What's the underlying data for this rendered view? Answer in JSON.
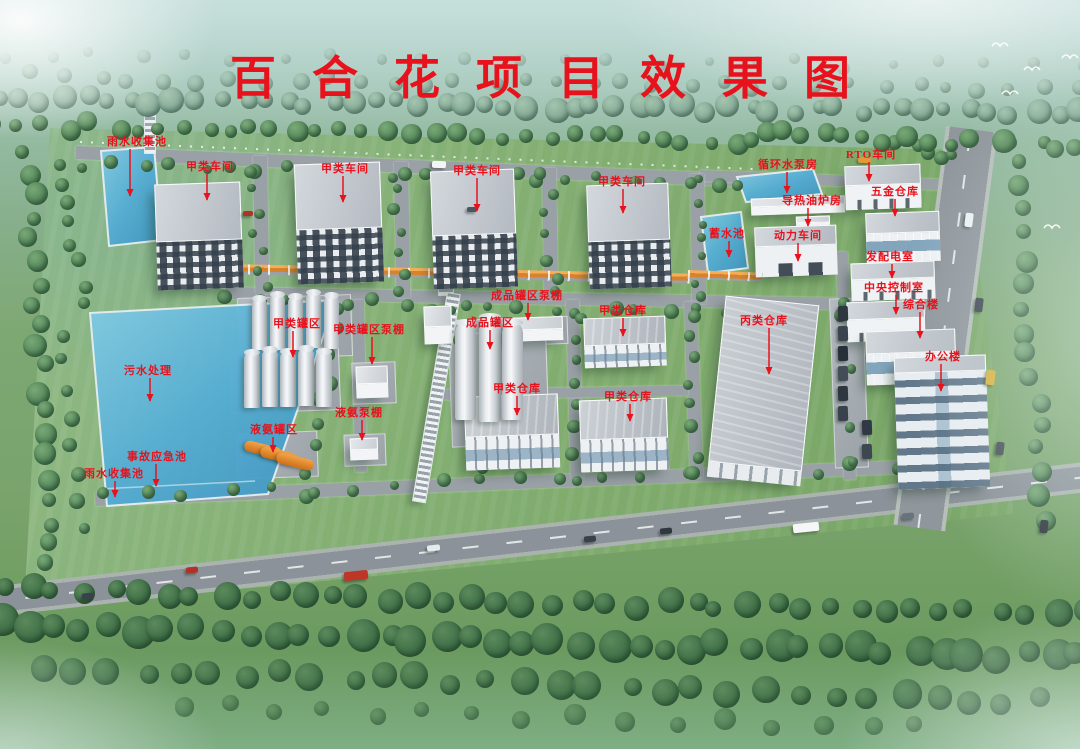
{
  "title": {
    "text": "百合花项目效果图"
  },
  "colors": {
    "label_red": "#e8121c",
    "pool_blue": "#54add4"
  },
  "annotations": [
    {
      "id": "rainwater-collection-pool-north",
      "text": "雨水收集池",
      "label": [
        137,
        141
      ],
      "line": [
        130,
        149,
        196
      ]
    },
    {
      "id": "class-a-workshop-1",
      "text": "甲类车间",
      "label": [
        210,
        166
      ],
      "line": [
        207,
        174,
        200
      ]
    },
    {
      "id": "class-a-workshop-2",
      "text": "甲类车间",
      "label": [
        345,
        168
      ],
      "line": [
        343,
        176,
        202
      ]
    },
    {
      "id": "class-a-workshop-3",
      "text": "甲类车间",
      "label": [
        477,
        170
      ],
      "line": [
        477,
        178,
        211
      ]
    },
    {
      "id": "class-a-workshop-4",
      "text": "甲类车间",
      "label": [
        622,
        181
      ],
      "line": [
        623,
        189,
        213
      ]
    },
    {
      "id": "circulating-water-pump-house",
      "text": "循环水泵房",
      "label": [
        788,
        164
      ],
      "line": [
        787,
        172,
        193
      ]
    },
    {
      "id": "rto-workshop",
      "text": "RTO车间",
      "label": [
        871,
        154
      ],
      "line": [
        869,
        162,
        181
      ]
    },
    {
      "id": "hardware-warehouse",
      "text": "五金仓库",
      "label": [
        895,
        191
      ],
      "line": [
        895,
        199,
        216
      ]
    },
    {
      "id": "thermal-oil-furnace-room",
      "text": "导热油炉房",
      "label": [
        812,
        200
      ],
      "line": [
        808,
        208,
        226
      ]
    },
    {
      "id": "reservoir",
      "text": "蓄水池",
      "label": [
        727,
        233
      ],
      "line": [
        729,
        241,
        257
      ]
    },
    {
      "id": "power-workshop",
      "text": "动力车间",
      "label": [
        798,
        235
      ],
      "line": [
        798,
        243,
        261
      ]
    },
    {
      "id": "power-distribution-room",
      "text": "发配电室",
      "label": [
        890,
        256
      ],
      "line": [
        892,
        264,
        278
      ]
    },
    {
      "id": "central-control-room",
      "text": "中央控制室",
      "label": [
        894,
        287
      ],
      "line": [
        896,
        295,
        314
      ]
    },
    {
      "id": "complex-building",
      "text": "综合楼",
      "label": [
        921,
        304
      ],
      "line": [
        920,
        312,
        338
      ]
    },
    {
      "id": "office-building",
      "text": "办公楼",
      "label": [
        943,
        356
      ],
      "line": [
        941,
        364,
        391
      ]
    },
    {
      "id": "class-a-tank-farm",
      "text": "甲类罐区",
      "label": [
        297,
        323
      ],
      "line": [
        293,
        331,
        357
      ]
    },
    {
      "id": "class-a-tank-farm-pump-shed",
      "text": "甲类罐区泵棚",
      "label": [
        369,
        329
      ],
      "line": [
        372,
        337,
        364
      ]
    },
    {
      "id": "finished-product-tank-pump-shed",
      "text": "成品罐区泵棚",
      "label": [
        527,
        295
      ],
      "line": [
        528,
        303,
        320
      ]
    },
    {
      "id": "finished-product-tank-farm",
      "text": "成品罐区",
      "label": [
        490,
        322
      ],
      "line": [
        490,
        330,
        349
      ]
    },
    {
      "id": "class-a-warehouse-1",
      "text": "甲类仓库",
      "label": [
        623,
        310
      ],
      "line": [
        623,
        318,
        336
      ]
    },
    {
      "id": "class-c-warehouse",
      "text": "丙类仓库",
      "label": [
        764,
        320
      ],
      "line": [
        769,
        328,
        374
      ]
    },
    {
      "id": "class-a-warehouse-2",
      "text": "甲类仓库",
      "label": [
        517,
        388
      ],
      "line": [
        517,
        396,
        415
      ]
    },
    {
      "id": "class-a-warehouse-3",
      "text": "甲类仓库",
      "label": [
        628,
        396
      ],
      "line": [
        630,
        404,
        421
      ]
    },
    {
      "id": "sewage-treatment",
      "text": "污水处理",
      "label": [
        148,
        370
      ],
      "line": [
        150,
        378,
        401
      ]
    },
    {
      "id": "liquid-ammonia-tank-farm",
      "text": "液氨罐区",
      "label": [
        274,
        429
      ],
      "line": [
        273,
        437,
        452
      ]
    },
    {
      "id": "liquid-ammonia-pump-shed",
      "text": "液氨泵棚",
      "label": [
        359,
        412
      ],
      "line": [
        362,
        420,
        440
      ]
    },
    {
      "id": "accident-emergency-pool",
      "text": "事故应急池",
      "label": [
        157,
        456
      ],
      "line": [
        156,
        464,
        486
      ]
    },
    {
      "id": "rainwater-collection-pool-south",
      "text": "雨水收集池",
      "label": [
        114,
        473
      ],
      "line": [
        115,
        481,
        497
      ]
    }
  ],
  "scene": {
    "buildings": [
      {
        "id": "class-a-workshop-1",
        "x": 156,
        "y": 183,
        "w": 86,
        "h": 106,
        "r": -2,
        "type": "workshop"
      },
      {
        "id": "class-a-workshop-2",
        "x": 296,
        "y": 163,
        "w": 86,
        "h": 120,
        "r": -2,
        "type": "workshop"
      },
      {
        "id": "class-a-workshop-3",
        "x": 432,
        "y": 170,
        "w": 84,
        "h": 118,
        "r": -2,
        "type": "workshop"
      },
      {
        "id": "class-a-workshop-4",
        "x": 588,
        "y": 184,
        "w": 82,
        "h": 104,
        "r": -2,
        "type": "workshop"
      },
      {
        "id": "circulating-water-pump-house",
        "x": 751,
        "y": 197,
        "w": 94,
        "h": 17,
        "r": -2,
        "type": "low"
      },
      {
        "id": "thermal-oil-furnace-room",
        "x": 796,
        "y": 216,
        "w": 34,
        "h": 13,
        "r": -2,
        "type": "low"
      },
      {
        "id": "power-workshop",
        "x": 755,
        "y": 226,
        "w": 82,
        "h": 50,
        "r": -2,
        "type": "plant"
      },
      {
        "id": "rto-workshop",
        "x": 845,
        "y": 165,
        "w": 76,
        "h": 44,
        "r": -2,
        "type": "flat"
      },
      {
        "id": "hardware-warehouse",
        "x": 866,
        "y": 212,
        "w": 74,
        "h": 50,
        "r": -2,
        "type": "glass"
      },
      {
        "id": "power-distribution-room",
        "x": 851,
        "y": 262,
        "w": 84,
        "h": 38,
        "r": -2,
        "type": "flat"
      },
      {
        "id": "central-control-room",
        "x": 847,
        "y": 301,
        "w": 78,
        "h": 40,
        "r": -2,
        "type": "flat"
      },
      {
        "id": "complex-building",
        "x": 866,
        "y": 330,
        "w": 90,
        "h": 54,
        "r": -2,
        "type": "glass"
      },
      {
        "id": "office-building",
        "x": 896,
        "y": 356,
        "w": 92,
        "h": 132,
        "r": -2,
        "type": "office"
      },
      {
        "id": "class-a-warehouse-1",
        "x": 584,
        "y": 317,
        "w": 82,
        "h": 50,
        "r": -2,
        "type": "warehouse"
      },
      {
        "id": "class-a-warehouse-2",
        "x": 465,
        "y": 395,
        "w": 94,
        "h": 74,
        "r": -2,
        "type": "warehouse"
      },
      {
        "id": "class-a-warehouse-3",
        "x": 580,
        "y": 399,
        "w": 88,
        "h": 72,
        "r": -2,
        "type": "warehouse"
      },
      {
        "id": "class-c-warehouse",
        "x": 716,
        "y": 300,
        "w": 94,
        "h": 182,
        "r": 6,
        "type": "longwh"
      },
      {
        "id": "finished-product-tank-pump-shed",
        "x": 503,
        "y": 317,
        "w": 60,
        "h": 24,
        "r": -2,
        "type": "low"
      },
      {
        "id": "class-a-tank-pump-shed",
        "x": 356,
        "y": 366,
        "w": 32,
        "h": 32,
        "r": -2,
        "type": "low"
      },
      {
        "id": "liquid-ammonia-pump-shed",
        "x": 350,
        "y": 438,
        "w": 28,
        "h": 22,
        "r": -2,
        "type": "low"
      },
      {
        "id": "corridor-shed",
        "x": 424,
        "y": 306,
        "w": 28,
        "h": 38,
        "r": -2,
        "type": "low"
      }
    ],
    "pools": [
      {
        "id": "north-rainwater-pool",
        "points": [
          [
            101,
            151
          ],
          [
            154,
            147
          ],
          [
            162,
            240
          ],
          [
            109,
            246
          ]
        ]
      },
      {
        "id": "main-pool",
        "points": [
          [
            90,
            313
          ],
          [
            336,
            300
          ],
          [
            268,
            494
          ],
          [
            107,
            506
          ]
        ],
        "dividers": [
          [
            100,
            489,
            255,
            481
          ]
        ]
      },
      {
        "id": "circulating-water-pool",
        "points": [
          [
            737,
            177
          ],
          [
            813,
            169
          ],
          [
            822,
            194
          ],
          [
            746,
            202
          ]
        ]
      },
      {
        "id": "reservoir-pool",
        "points": [
          [
            701,
            217
          ],
          [
            741,
            212
          ],
          [
            748,
            268
          ],
          [
            708,
            273
          ]
        ]
      }
    ],
    "tank_groups": [
      {
        "id": "class-a-tank-group-1",
        "style": "vertical",
        "tanks": [
          [
            252,
            298,
            15,
            52
          ],
          [
            270,
            294,
            15,
            56
          ],
          [
            288,
            296,
            15,
            54
          ],
          [
            306,
            292,
            15,
            56
          ],
          [
            324,
            295,
            15,
            54
          ]
        ]
      },
      {
        "id": "class-a-tank-group-2",
        "style": "vertical",
        "tanks": [
          [
            244,
            352,
            16,
            56
          ],
          [
            262,
            349,
            16,
            58
          ],
          [
            280,
            351,
            16,
            56
          ],
          [
            298,
            348,
            16,
            58
          ],
          [
            316,
            351,
            16,
            56
          ]
        ]
      },
      {
        "id": "finished-product-tanks",
        "style": "vertical",
        "tanks": [
          [
            455,
            322,
            21,
            98
          ],
          [
            479,
            316,
            22,
            106
          ],
          [
            502,
            322,
            21,
            98
          ]
        ]
      },
      {
        "id": "liquid-ammonia-tanks",
        "style": "horizontal",
        "tanks": [
          [
            244,
            444,
            38,
            11
          ],
          [
            260,
            450,
            38,
            11
          ],
          [
            276,
            456,
            38,
            11
          ]
        ]
      }
    ]
  }
}
